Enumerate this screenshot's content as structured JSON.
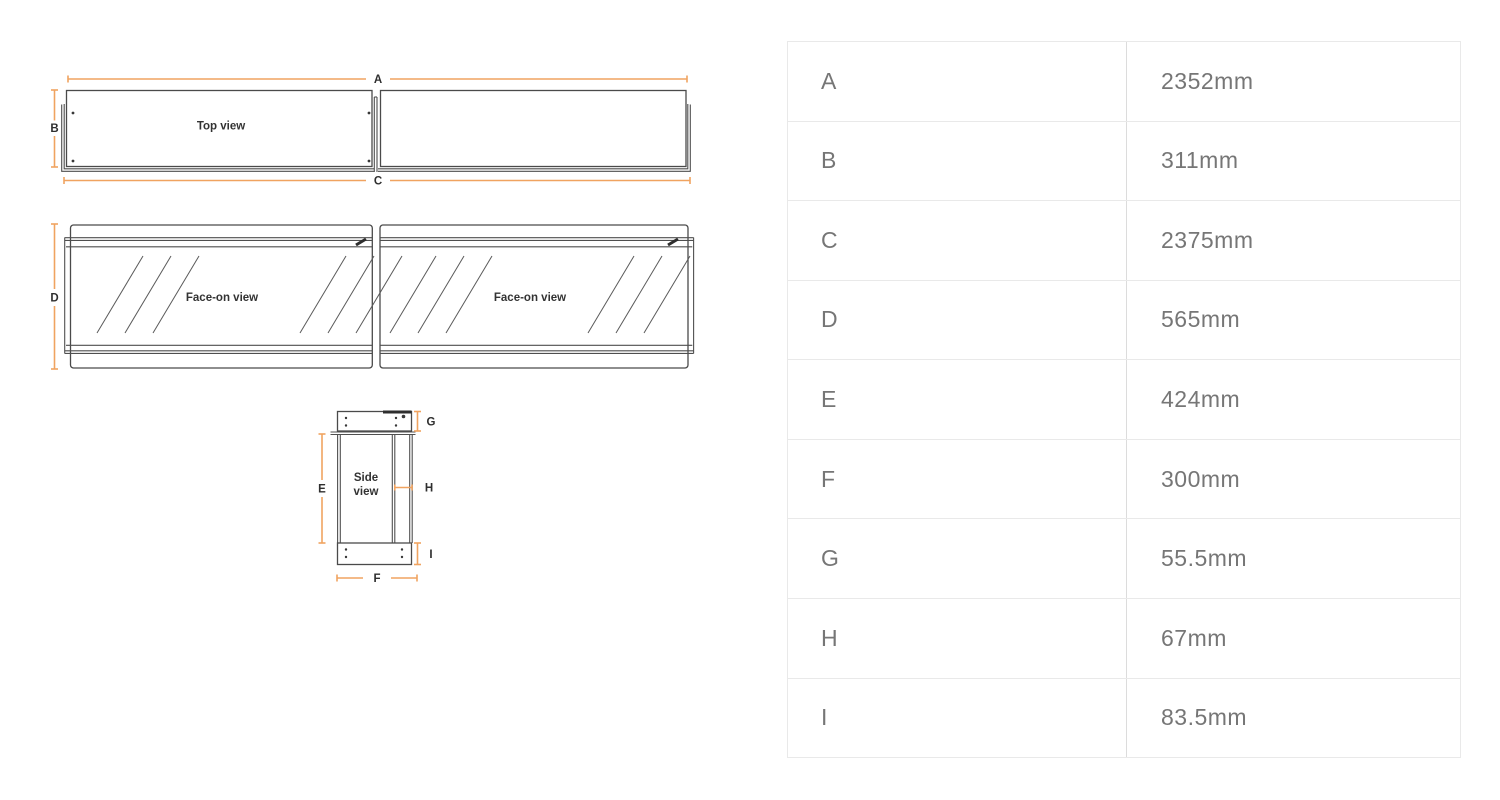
{
  "diagram": {
    "top_view_label": "Top view",
    "face_on_left_label": "Face-on view",
    "face_on_right_label": "Face-on view",
    "side_view_label_line1": "Side",
    "side_view_label_line2": "view",
    "colors": {
      "dimension_line": "#F0A360",
      "drawing_line": "#4A4A4A",
      "label_text": "#333333",
      "table_text": "#767676",
      "table_border": "#E9E9E9"
    }
  },
  "dimensions": [
    {
      "key": "A",
      "value": "2352mm"
    },
    {
      "key": "B",
      "value": "311mm"
    },
    {
      "key": "C",
      "value": "2375mm"
    },
    {
      "key": "D",
      "value": "565mm"
    },
    {
      "key": "E",
      "value": "424mm"
    },
    {
      "key": "F",
      "value": "300mm"
    },
    {
      "key": "G",
      "value": "55.5mm"
    },
    {
      "key": "H",
      "value": "67mm"
    },
    {
      "key": "I",
      "value": "83.5mm"
    }
  ]
}
